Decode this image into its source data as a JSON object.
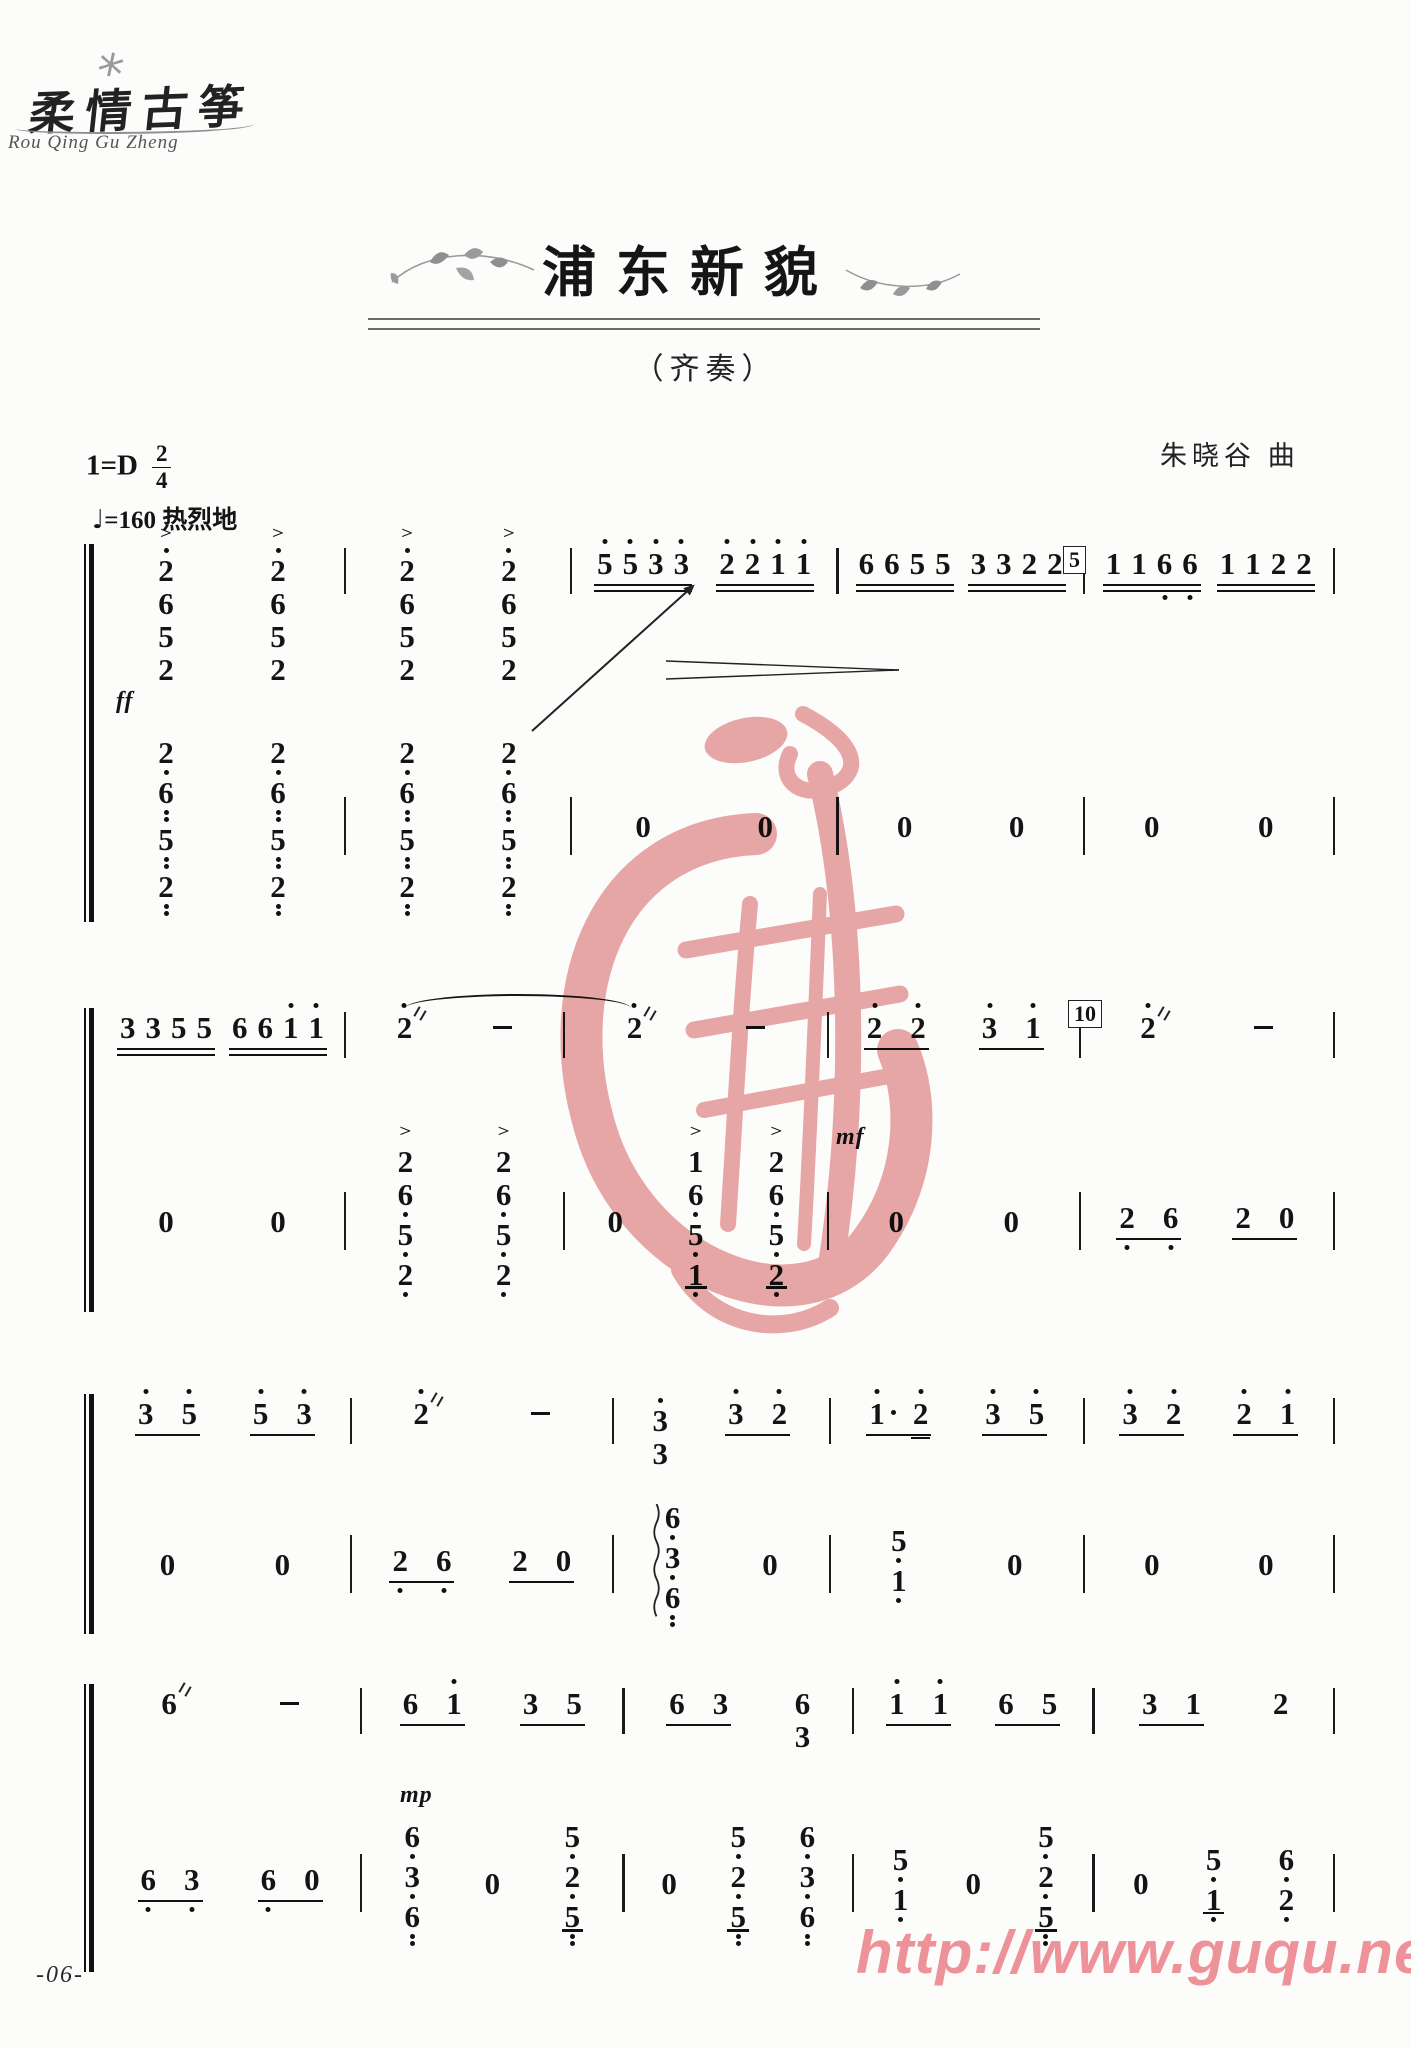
{
  "meta": {
    "logo_cn": "柔情古筝",
    "logo_en": "Rou Qing Gu Zheng",
    "title": "浦东新貌",
    "subtitle": "（齐奏）",
    "key_signature": "1=D",
    "time_numerator": "2",
    "time_denominator": "4",
    "tempo_note": "♩",
    "tempo_value": "=160",
    "tempo_expression": "热烈地",
    "composer": "朱晓谷 曲"
  },
  "footer": {
    "page_number": "-06-",
    "watermark_url": "http://www.guqu.net"
  },
  "colors": {
    "ink": "#141414",
    "watermark_pink": "#e9a3a4",
    "url_pink": "#ef949b"
  },
  "notation_legend": "tokens: digit, '=dot above (high octave), ,=dot below (low octave), .=augmentation dot, ~=tremolo, ==extra 16th beam; g=beamed group (u=number of beams); c=chord stack top->bottom; acc=accent; arp=arpeggio",
  "systems": [
    {
      "top": 548,
      "height": 372,
      "lowerTop": 184,
      "weights": [
        1.1,
        1,
        1.2,
        1.1,
        1.12
      ],
      "upper": [
        [
          {
            "c": [
              "2'",
              "6",
              "5",
              "2"
            ],
            "acc": 1
          },
          {
            "c": [
              "2'",
              "6",
              "5",
              "2"
            ],
            "acc": 1
          }
        ],
        [
          {
            "c": [
              "2'",
              "6",
              "5",
              "2"
            ],
            "acc": 1
          },
          {
            "c": [
              "2'",
              "6",
              "5",
              "2"
            ],
            "acc": 1
          }
        ],
        [
          {
            "g": [
              "5'",
              "5'",
              "3'",
              "3'"
            ],
            "u": 2
          },
          {
            "g": [
              "2'",
              "2'",
              "1'",
              "1'"
            ],
            "u": 2
          }
        ],
        [
          {
            "g": [
              "6",
              "6",
              "5",
              "5"
            ],
            "u": 2
          },
          {
            "g": [
              "3",
              "3",
              "2",
              "2"
            ],
            "u": 2
          }
        ],
        [
          {
            "g": [
              "1",
              "1",
              "6,",
              "6,"
            ],
            "u": 2
          },
          {
            "g": [
              "1",
              "1",
              "2",
              "2"
            ],
            "u": 2
          }
        ]
      ],
      "lower": [
        [
          {
            "c": [
              "2,",
              "6,,",
              "5,,",
              "2,,"
            ]
          },
          {
            "c": [
              "2,",
              "6,,",
              "5,,",
              "2,,"
            ]
          }
        ],
        [
          {
            "c": [
              "2,",
              "6,,",
              "5,,",
              "2,,"
            ]
          },
          {
            "c": [
              "2,",
              "6,,",
              "5,,",
              "2,,"
            ]
          }
        ],
        [
          "0",
          "0"
        ],
        [
          "0",
          "0"
        ],
        [
          "0",
          "0"
        ]
      ],
      "boxes": [
        {
          "left": 963,
          "top": -2,
          "label": "5"
        }
      ],
      "dyn": [
        {
          "stave": "upper",
          "left": 16,
          "top": 140,
          "label": "ff"
        }
      ],
      "marks": [
        {
          "type": "gliss",
          "stave": "upper",
          "left": 432,
          "top": 182,
          "len": 210,
          "angle": -42
        },
        {
          "type": "dim",
          "stave": "upper",
          "left": 566,
          "top": 112,
          "w": 235,
          "h": 20
        }
      ]
    },
    {
      "top": 1012,
      "height": 298,
      "lowerTop": 120,
      "weights": [
        1.14,
        1,
        1.23,
        1.17,
        1.18
      ],
      "upper": [
        [
          {
            "g": [
              "3",
              "3",
              "5",
              "5"
            ],
            "u": 2
          },
          {
            "g": [
              "6",
              "6",
              "1'",
              "1'"
            ],
            "u": 2
          }
        ],
        [
          "2'~",
          "-"
        ],
        [
          "2'~",
          "-"
        ],
        [
          {
            "g": [
              "2'",
              "2'"
            ],
            "u": 1
          },
          {
            "g": [
              "3'",
              "1'"
            ],
            "u": 1
          }
        ],
        [
          "2'~",
          "-"
        ]
      ],
      "lower": [
        [
          "0",
          "0"
        ],
        [
          {
            "c": [
              "2",
              "6,",
              "5,",
              "2,"
            ],
            "acc": 1
          },
          {
            "c": [
              "2",
              "6,",
              "5,",
              "2,"
            ],
            "acc": 1
          }
        ],
        [
          "0",
          {
            "c": [
              "1",
              "6,",
              "5,",
              "1,"
            ],
            "acc": 1,
            "u": 1
          },
          {
            "c": [
              "2",
              "6,",
              "5,",
              "2,"
            ],
            "acc": 1,
            "u": 1
          }
        ],
        [
          "0",
          "0"
        ],
        [
          {
            "g": [
              "2,",
              "6,"
            ],
            "u": 1
          },
          {
            "g": [
              "2",
              "0"
            ],
            "u": 1
          }
        ]
      ],
      "boxes": [
        {
          "left": 968,
          "top": -12,
          "label": "10"
        }
      ],
      "dyn": [
        {
          "stave": "upper",
          "left": 736,
          "top": 112,
          "label": "mf"
        }
      ],
      "marks": [
        {
          "type": "slur",
          "stave": "upper",
          "left": 305,
          "top": -18,
          "w": 226,
          "h": 22
        }
      ]
    },
    {
      "top": 1398,
      "height": 234,
      "lowerTop": 98,
      "weights": [
        1.18,
        1.23,
        1,
        1.19,
        1.17
      ],
      "upper": [
        [
          {
            "g": [
              "3'",
              "5'"
            ],
            "u": 1
          },
          {
            "g": [
              "5'",
              "3'"
            ],
            "u": 1
          }
        ],
        [
          "2'~",
          "-"
        ],
        [
          {
            "c": [
              "3'",
              "3"
            ]
          },
          {
            "g": [
              "3'",
              "2'"
            ],
            "u": 1
          }
        ],
        [
          {
            "g": [
              "1'.",
              "2'="
            ],
            "u": 1
          },
          {
            "g": [
              "3'",
              "5'"
            ],
            "u": 1
          }
        ],
        [
          {
            "g": [
              "3'",
              "2'"
            ],
            "u": 1
          },
          {
            "g": [
              "2'",
              "1'"
            ],
            "u": 1
          }
        ]
      ],
      "lower": [
        [
          "0",
          "0"
        ],
        [
          {
            "g": [
              "2,",
              "6,"
            ],
            "u": 1
          },
          {
            "g": [
              "2",
              "0"
            ],
            "u": 1
          }
        ],
        [
          {
            "c": [
              "6,",
              "3,",
              "6,,"
            ],
            "arp": 1
          },
          "0"
        ],
        [
          {
            "c": [
              "5,",
              "1,"
            ]
          },
          "0"
        ],
        [
          "0",
          "0"
        ]
      ],
      "boxes": [],
      "dyn": [],
      "marks": []
    },
    {
      "top": 1688,
      "height": 282,
      "lowerTop": 108,
      "weights": [
        1.1,
        1.1,
        0.95,
        1,
        1
      ],
      "upper": [
        [
          "6~",
          "-"
        ],
        [
          {
            "g": [
              "6",
              "1'"
            ],
            "u": 1
          },
          {
            "g": [
              "3",
              "5"
            ],
            "u": 1
          }
        ],
        [
          {
            "g": [
              "6",
              "3"
            ],
            "u": 1
          },
          {
            "c": [
              "6",
              "3"
            ]
          }
        ],
        [
          {
            "g": [
              "1'",
              "1'"
            ],
            "u": 1
          },
          {
            "g": [
              "6",
              "5"
            ],
            "u": 1
          }
        ],
        [
          {
            "g": [
              "3",
              "1"
            ],
            "u": 1
          },
          "2"
        ]
      ],
      "lower": [
        [
          {
            "g": [
              "6,",
              "3,"
            ],
            "u": 1
          },
          {
            "g": [
              "6,",
              "0"
            ],
            "u": 1
          }
        ],
        [
          {
            "c": [
              "6,",
              "3,",
              "6,,"
            ]
          },
          "0",
          {
            "c": [
              "5,",
              "2,",
              "5,,"
            ],
            "u": 1
          }
        ],
        [
          "0",
          {
            "c": [
              "5,",
              "2,",
              "5,,"
            ],
            "u": 1
          },
          {
            "c": [
              "6,",
              "3,",
              "6,,"
            ]
          }
        ],
        [
          {
            "c": [
              "5,",
              "1,"
            ]
          },
          "0",
          {
            "c": [
              "5,",
              "2,",
              "5,,"
            ],
            "u": 1
          }
        ],
        [
          "0",
          {
            "c": [
              "5,",
              "1,"
            ],
            "u": 1
          },
          {
            "c": [
              "6,",
              "2,"
            ]
          }
        ]
      ],
      "boxes": [],
      "dyn": [
        {
          "stave": "upper",
          "left": 300,
          "top": 94,
          "label": "mp"
        }
      ],
      "marks": []
    }
  ]
}
